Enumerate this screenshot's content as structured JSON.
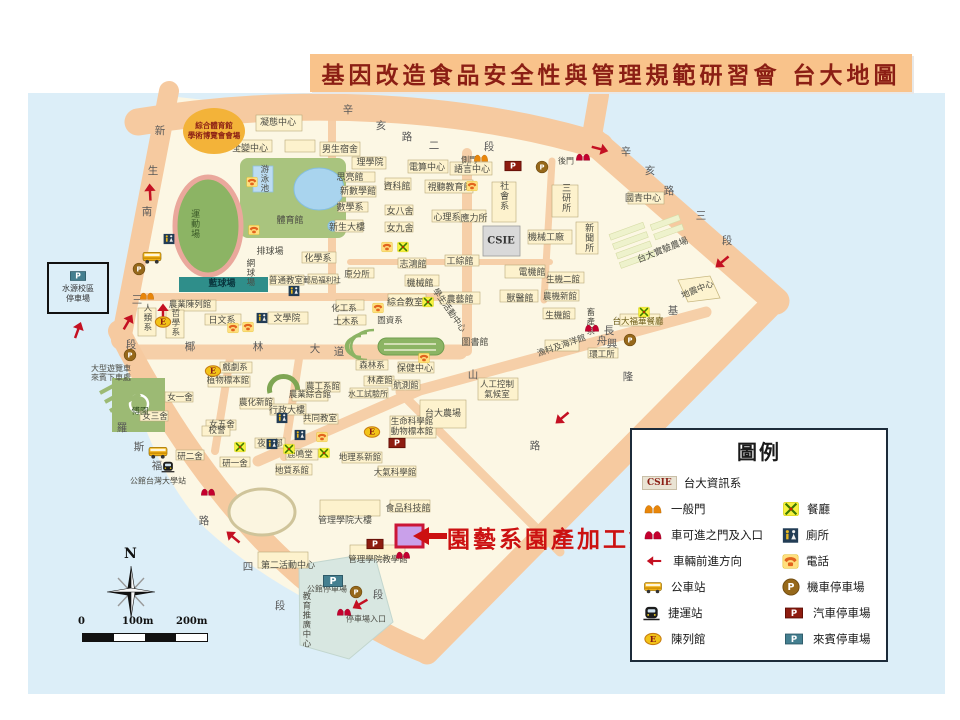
{
  "title": {
    "banner": "基因改造食品安全性與管理規範研習會 台大地圖"
  },
  "callout": {
    "label": "園藝系園產加工館"
  },
  "compass": {
    "north": "N"
  },
  "scalebar": {
    "t0": "0",
    "t100": "100m",
    "t200": "200m"
  },
  "legend": {
    "title": "圖例",
    "csie_chip": "CSIE",
    "items": {
      "csie": "台大資訊系",
      "gate": "一般門",
      "rest": "餐廳",
      "vgate": "車可進之門及入口",
      "toilet": "廁所",
      "dir": "車輛前進方向",
      "phone": "電話",
      "bus": "公車站",
      "moto": "機車停車場",
      "mrt": "捷運站",
      "car": "汽車停車場",
      "exhibit": "陳列館",
      "guest": "來賓停車場"
    }
  },
  "colors": {
    "banner_bg": "#f9c38b",
    "banner_text": "#8b1e14",
    "callout": "#cc1111",
    "water": "#dceef8",
    "road": "#f6caa0",
    "campus": "#fcf7e4",
    "highlight": "#c9a0ea"
  },
  "map": {
    "csie_box": "CSIE",
    "sports_circle": {
      "line1": "綜合體育館",
      "line2": "學術博覽會會場"
    },
    "shuiyuan": {
      "line1": "水源校區",
      "line2": "停車場"
    },
    "street_chars": [
      {
        "t": "新",
        "x": 160,
        "y": 131
      },
      {
        "t": "生",
        "x": 153,
        "y": 171
      },
      {
        "t": "南",
        "x": 147,
        "y": 212
      },
      {
        "t": "三",
        "x": 137,
        "y": 300
      },
      {
        "t": "段",
        "x": 131,
        "y": 345
      },
      {
        "t": "羅",
        "x": 122,
        "y": 428
      },
      {
        "t": "斯",
        "x": 139,
        "y": 447
      },
      {
        "t": "福",
        "x": 157,
        "y": 466
      },
      {
        "t": "路",
        "x": 204,
        "y": 521
      },
      {
        "t": "四",
        "x": 248,
        "y": 567
      },
      {
        "t": "段",
        "x": 280,
        "y": 606
      },
      {
        "t": "辛",
        "x": 348,
        "y": 110
      },
      {
        "t": "亥",
        "x": 381,
        "y": 126
      },
      {
        "t": "路",
        "x": 407,
        "y": 137
      },
      {
        "t": "二",
        "x": 434,
        "y": 146
      },
      {
        "t": "段",
        "x": 489,
        "y": 147
      },
      {
        "t": "辛",
        "x": 626,
        "y": 152
      },
      {
        "t": "亥",
        "x": 650,
        "y": 171
      },
      {
        "t": "路",
        "x": 669,
        "y": 191
      },
      {
        "t": "三",
        "x": 701,
        "y": 216
      },
      {
        "t": "段",
        "x": 727,
        "y": 241
      },
      {
        "t": "基",
        "x": 673,
        "y": 311
      },
      {
        "t": "隆",
        "x": 628,
        "y": 377
      },
      {
        "t": "路",
        "x": 535,
        "y": 446
      },
      {
        "t": "段",
        "x": 378,
        "y": 595
      },
      {
        "t": "椰",
        "x": 190,
        "y": 347
      },
      {
        "t": "林",
        "x": 258,
        "y": 347
      },
      {
        "t": "大",
        "x": 315,
        "y": 349
      },
      {
        "t": "道",
        "x": 339,
        "y": 352
      },
      {
        "t": "舟",
        "x": 602,
        "y": 341
      },
      {
        "t": "山",
        "x": 473,
        "y": 375
      },
      {
        "t": "長",
        "x": 609,
        "y": 331
      },
      {
        "t": "興",
        "x": 612,
        "y": 344
      }
    ],
    "labels": [
      {
        "t": "凝態中心",
        "x": 278,
        "y": 123
      },
      {
        "t": "全變中心",
        "x": 250,
        "y": 149
      },
      {
        "t": "男生宿舍",
        "x": 340,
        "y": 150
      },
      {
        "t": "理學院",
        "x": 370,
        "y": 163
      },
      {
        "t": "思亮館",
        "x": 350,
        "y": 178
      },
      {
        "t": "新數學館",
        "x": 358,
        "y": 192
      },
      {
        "t": "數學系",
        "x": 350,
        "y": 208
      },
      {
        "t": "新生大樓",
        "x": 347,
        "y": 228
      },
      {
        "t": "資科館",
        "x": 397,
        "y": 187
      },
      {
        "t": "電算中心",
        "x": 427,
        "y": 168
      },
      {
        "t": "側門",
        "x": 469,
        "y": 160,
        "s": 8
      },
      {
        "t": "語言中心",
        "x": 472,
        "y": 170
      },
      {
        "t": "視聽教育館",
        "x": 450,
        "y": 188
      },
      {
        "t": "女八舍",
        "x": 400,
        "y": 212
      },
      {
        "t": "女九舍",
        "x": 400,
        "y": 229
      },
      {
        "t": "心理系",
        "x": 447,
        "y": 218
      },
      {
        "t": "應力所",
        "x": 474,
        "y": 219
      },
      {
        "t": "社會系",
        "x": 503,
        "y": 196,
        "v": 1
      },
      {
        "t": "三研所",
        "x": 565,
        "y": 198,
        "v": 1
      },
      {
        "t": "機械工廠",
        "x": 546,
        "y": 238
      },
      {
        "t": "新聞所",
        "x": 588,
        "y": 238,
        "v": 1
      },
      {
        "t": "後門",
        "x": 566,
        "y": 161,
        "s": 8
      },
      {
        "t": "國青中心",
        "x": 643,
        "y": 199
      },
      {
        "t": "台大實驗農場",
        "x": 663,
        "y": 251,
        "r": -22
      },
      {
        "t": "地震中心",
        "x": 698,
        "y": 291,
        "r": -22,
        "s": 8.5
      },
      {
        "t": "游泳池",
        "x": 263,
        "y": 179,
        "v": 1,
        "s": 8.5
      },
      {
        "t": "體育館",
        "x": 290,
        "y": 221
      },
      {
        "t": "運動場",
        "x": 194,
        "y": 224,
        "v": 1,
        "c": "#3b5a28"
      },
      {
        "t": "排球場",
        "x": 270,
        "y": 252
      },
      {
        "t": "網球場",
        "x": 249,
        "y": 273,
        "v": 1,
        "s": 8.5
      },
      {
        "t": "藍球場",
        "x": 222,
        "y": 284,
        "c": "#09353d",
        "s": 9,
        "b": 1
      },
      {
        "t": "普通教室",
        "x": 286,
        "y": 282,
        "s": 8.5
      },
      {
        "t": "郵局福利社",
        "x": 322,
        "y": 281,
        "s": 7.5
      },
      {
        "t": "化學系",
        "x": 318,
        "y": 259
      },
      {
        "t": "原分所",
        "x": 357,
        "y": 276,
        "s": 8.5
      },
      {
        "t": "化工系",
        "x": 344,
        "y": 310,
        "s": 8.5
      },
      {
        "t": "土木系",
        "x": 346,
        "y": 323,
        "s": 8.5
      },
      {
        "t": "機械館",
        "x": 420,
        "y": 284
      },
      {
        "t": "志鴻館",
        "x": 413,
        "y": 265
      },
      {
        "t": "工綜館",
        "x": 460,
        "y": 262
      },
      {
        "t": "電機館",
        "x": 532,
        "y": 273
      },
      {
        "t": "生機二館",
        "x": 563,
        "y": 281,
        "s": 8.5
      },
      {
        "t": "農機新館",
        "x": 560,
        "y": 298,
        "s": 8.5
      },
      {
        "t": "生機館",
        "x": 558,
        "y": 317,
        "s": 8.5
      },
      {
        "t": "畜產系",
        "x": 589,
        "y": 322,
        "v": 1,
        "s": 8.5
      },
      {
        "t": "獸醫館",
        "x": 520,
        "y": 299
      },
      {
        "t": "農藝館",
        "x": 460,
        "y": 300
      },
      {
        "t": "綜合教室",
        "x": 405,
        "y": 303
      },
      {
        "t": "學生活動中心",
        "x": 448,
        "y": 311,
        "r": 55,
        "s": 8.5
      },
      {
        "t": "圖資系",
        "x": 390,
        "y": 322,
        "s": 8.5
      },
      {
        "t": "圖書館",
        "x": 475,
        "y": 343
      },
      {
        "t": "農業陳列館",
        "x": 190,
        "y": 306,
        "s": 8.5
      },
      {
        "t": "人類系",
        "x": 146,
        "y": 318,
        "v": 1,
        "s": 8.5
      },
      {
        "t": "哲學系",
        "x": 174,
        "y": 323,
        "v": 1,
        "s": 8.5
      },
      {
        "t": "日文系",
        "x": 222,
        "y": 321
      },
      {
        "t": "文學院",
        "x": 287,
        "y": 319
      },
      {
        "t": "大型遊覽車\n來賓下車處",
        "x": 111,
        "y": 373,
        "s": 8
      },
      {
        "t": "傅園",
        "x": 140,
        "y": 413,
        "c": "#2c4a1c",
        "s": 8.5
      },
      {
        "t": "戲劇系",
        "x": 235,
        "y": 369,
        "s": 8.5
      },
      {
        "t": "植物標本館",
        "x": 228,
        "y": 382,
        "s": 8.5
      },
      {
        "t": "女一舍",
        "x": 180,
        "y": 399,
        "s": 8.5
      },
      {
        "t": "女三舍",
        "x": 155,
        "y": 418,
        "s": 8.5
      },
      {
        "t": "女五舍",
        "x": 222,
        "y": 426,
        "s": 8.5
      },
      {
        "t": "農化新館",
        "x": 256,
        "y": 404,
        "s": 8.5
      },
      {
        "t": "行政大樓",
        "x": 287,
        "y": 411
      },
      {
        "t": "農業綜合館",
        "x": 310,
        "y": 396,
        "s": 8.5
      },
      {
        "t": "農工系館",
        "x": 323,
        "y": 388,
        "s": 8.5
      },
      {
        "t": "共同教室",
        "x": 320,
        "y": 420,
        "s": 8.5
      },
      {
        "t": "校警",
        "x": 217,
        "y": 432,
        "s": 8.5
      },
      {
        "t": "保健中心",
        "x": 415,
        "y": 369
      },
      {
        "t": "森林系",
        "x": 372,
        "y": 367,
        "s": 8.5
      },
      {
        "t": "林產館",
        "x": 380,
        "y": 382,
        "s": 8.5
      },
      {
        "t": "航測館",
        "x": 406,
        "y": 387,
        "s": 8.5
      },
      {
        "t": "水工試驗所",
        "x": 368,
        "y": 394,
        "s": 8
      },
      {
        "t": "人工控制\n氣候室",
        "x": 497,
        "y": 391,
        "s": 8.5
      },
      {
        "t": "台大農場",
        "x": 443,
        "y": 414
      },
      {
        "t": "生命科學館",
        "x": 412,
        "y": 423,
        "s": 8.5
      },
      {
        "t": "動物標本館",
        "x": 412,
        "y": 433,
        "s": 8.5
      },
      {
        "t": "漁科及海洋館",
        "x": 562,
        "y": 347,
        "r": -19,
        "s": 8.5
      },
      {
        "t": "環工所",
        "x": 602,
        "y": 356,
        "s": 8.5
      },
      {
        "t": "台大福華餐廳",
        "x": 638,
        "y": 323,
        "s": 8.5,
        "c": "#6b5b16"
      },
      {
        "t": "夜間部",
        "x": 270,
        "y": 445,
        "s": 8.5
      },
      {
        "t": "鹿鳴堂",
        "x": 300,
        "y": 456,
        "s": 8.5
      },
      {
        "t": "研二舍",
        "x": 190,
        "y": 458,
        "s": 8.5
      },
      {
        "t": "研一舍",
        "x": 235,
        "y": 465,
        "s": 8.5
      },
      {
        "t": "公館台灣大學站",
        "x": 158,
        "y": 481,
        "s": 8
      },
      {
        "t": "地質系館",
        "x": 292,
        "y": 472,
        "s": 8.5
      },
      {
        "t": "地理系新館",
        "x": 360,
        "y": 459,
        "s": 8.5
      },
      {
        "t": "大氣科學館",
        "x": 395,
        "y": 474,
        "s": 8.5
      },
      {
        "t": "食品科技館",
        "x": 408,
        "y": 509
      },
      {
        "t": "管理學院大樓",
        "x": 345,
        "y": 521
      },
      {
        "t": "管理學院教學館",
        "x": 378,
        "y": 561,
        "s": 8.5
      },
      {
        "t": "第二活動中心",
        "x": 288,
        "y": 566
      },
      {
        "t": "公館停車場",
        "x": 327,
        "y": 589,
        "s": 8
      },
      {
        "t": "教育推廣中心",
        "x": 305,
        "y": 620,
        "v": 1,
        "s": 8.5
      },
      {
        "t": "停車場入口",
        "x": 366,
        "y": 619,
        "s": 8
      }
    ],
    "icons": [
      {
        "k": "gateO",
        "x": 481,
        "y": 158
      },
      {
        "k": "gateO",
        "x": 147,
        "y": 296
      },
      {
        "k": "gateR",
        "x": 583,
        "y": 157
      },
      {
        "k": "gateR",
        "x": 592,
        "y": 328
      },
      {
        "k": "gateR",
        "x": 208,
        "y": 492
      },
      {
        "k": "gateR",
        "x": 344,
        "y": 612
      },
      {
        "k": "gateR",
        "x": 403,
        "y": 555
      },
      {
        "k": "arrow",
        "x": 150,
        "y": 192,
        "r": -93
      },
      {
        "k": "arrow",
        "x": 163,
        "y": 312,
        "r": -90
      },
      {
        "k": "arrow",
        "x": 600,
        "y": 149,
        "r": 15
      },
      {
        "k": "arrow",
        "x": 722,
        "y": 262,
        "r": 140
      },
      {
        "k": "arrow",
        "x": 562,
        "y": 418,
        "r": 140
      },
      {
        "k": "arrow",
        "x": 233,
        "y": 537,
        "r": -140
      },
      {
        "k": "arrow",
        "x": 360,
        "y": 604,
        "r": 150
      },
      {
        "k": "arrow",
        "x": 78,
        "y": 330,
        "r": -70
      },
      {
        "k": "arrow",
        "x": 128,
        "y": 322,
        "r": -60
      },
      {
        "k": "bus",
        "x": 152,
        "y": 257
      },
      {
        "k": "bus",
        "x": 158,
        "y": 452
      },
      {
        "k": "mrt",
        "x": 168,
        "y": 467
      },
      {
        "k": "E",
        "x": 163,
        "y": 322
      },
      {
        "k": "E",
        "x": 213,
        "y": 371
      },
      {
        "k": "E",
        "x": 372,
        "y": 432
      },
      {
        "k": "rest",
        "x": 428,
        "y": 302
      },
      {
        "k": "rest",
        "x": 644,
        "y": 312
      },
      {
        "k": "rest",
        "x": 289,
        "y": 449
      },
      {
        "k": "rest",
        "x": 324,
        "y": 453
      },
      {
        "k": "rest",
        "x": 240,
        "y": 447
      },
      {
        "k": "rest",
        "x": 403,
        "y": 247
      },
      {
        "k": "phone",
        "x": 252,
        "y": 182
      },
      {
        "k": "phone",
        "x": 254,
        "y": 230
      },
      {
        "k": "phone",
        "x": 233,
        "y": 328
      },
      {
        "k": "phone",
        "x": 248,
        "y": 327
      },
      {
        "k": "phone",
        "x": 378,
        "y": 308
      },
      {
        "k": "phone",
        "x": 424,
        "y": 358
      },
      {
        "k": "phone",
        "x": 472,
        "y": 186
      },
      {
        "k": "phone",
        "x": 387,
        "y": 247
      },
      {
        "k": "phone",
        "x": 322,
        "y": 437
      },
      {
        "k": "toilet",
        "x": 169,
        "y": 239
      },
      {
        "k": "toilet",
        "x": 294,
        "y": 291
      },
      {
        "k": "toilet",
        "x": 262,
        "y": 318
      },
      {
        "k": "toilet",
        "x": 282,
        "y": 418
      },
      {
        "k": "toilet",
        "x": 300,
        "y": 435
      },
      {
        "k": "toilet",
        "x": 272,
        "y": 444
      },
      {
        "k": "pbrown",
        "x": 542,
        "y": 167
      },
      {
        "k": "pbrown",
        "x": 630,
        "y": 340
      },
      {
        "k": "pbrown",
        "x": 139,
        "y": 269
      },
      {
        "k": "pbrown",
        "x": 130,
        "y": 355
      },
      {
        "k": "pbrown",
        "x": 356,
        "y": 592
      },
      {
        "k": "pred",
        "x": 513,
        "y": 166
      },
      {
        "k": "pred",
        "x": 397,
        "y": 443
      },
      {
        "k": "pred",
        "x": 375,
        "y": 544
      },
      {
        "k": "pteal",
        "x": 333,
        "y": 581
      }
    ]
  }
}
